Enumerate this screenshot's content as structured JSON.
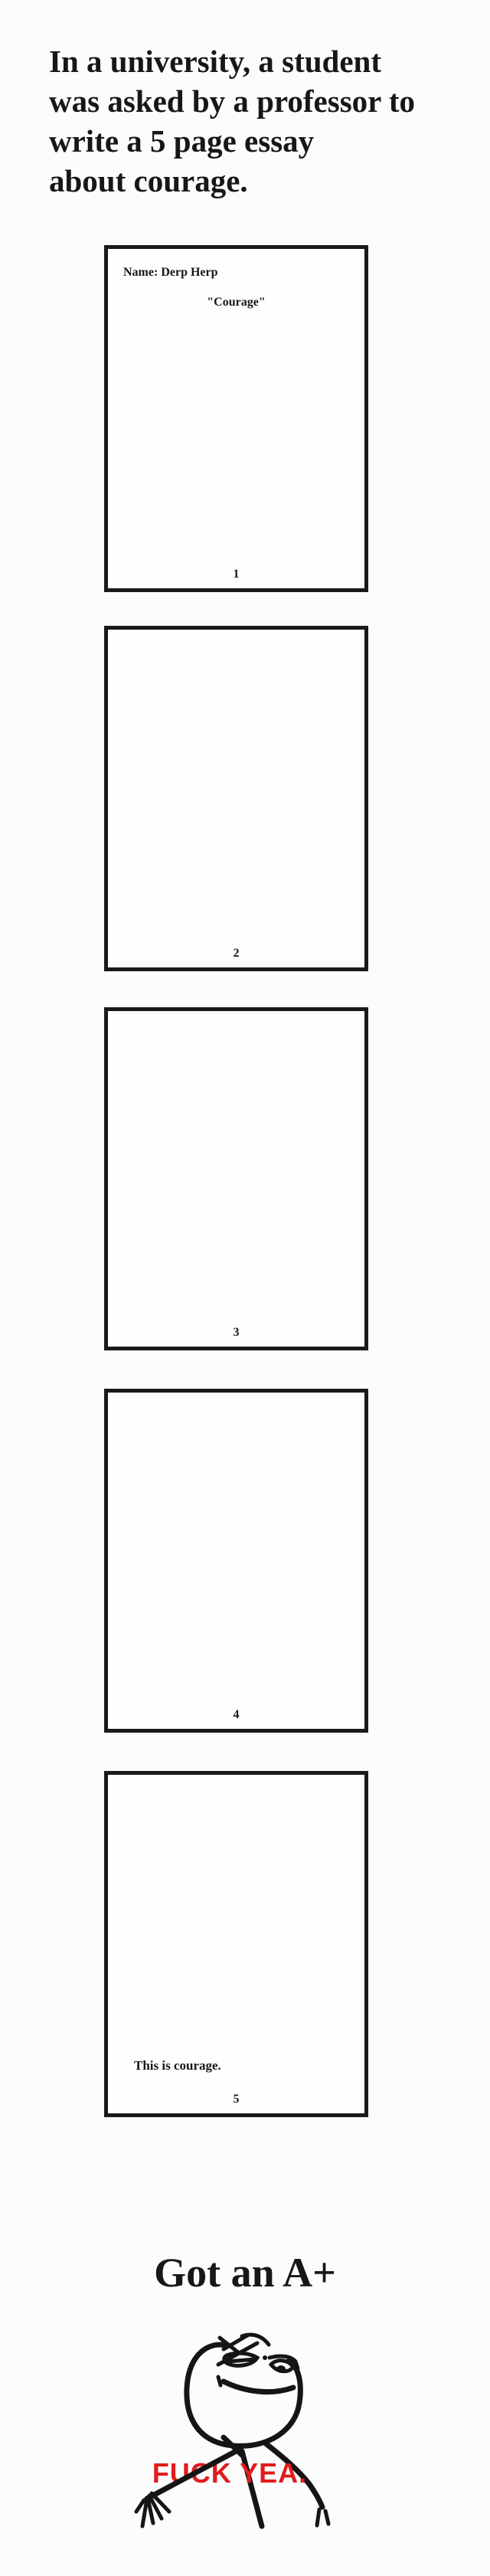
{
  "intro": {
    "lines": [
      "In a university, a student",
      "was asked by a professor to",
      "write a 5 page essay",
      "about courage."
    ]
  },
  "essay": {
    "pages": [
      {
        "number": "1",
        "header": "Name: Derp Herp",
        "title": "\"Courage\""
      },
      {
        "number": "2"
      },
      {
        "number": "3"
      },
      {
        "number": "4"
      },
      {
        "number": "5",
        "closing": "This is courage."
      }
    ]
  },
  "result": {
    "caption": "Got an A+"
  },
  "meme": {
    "caption": "FUCK YEA.",
    "figure": "fuck-yea-rage-face"
  },
  "colors": {
    "background": "#fcfcfc",
    "ink": "#171717",
    "page_border": "#1a1a1a",
    "meme_red": "#e21b1b"
  }
}
